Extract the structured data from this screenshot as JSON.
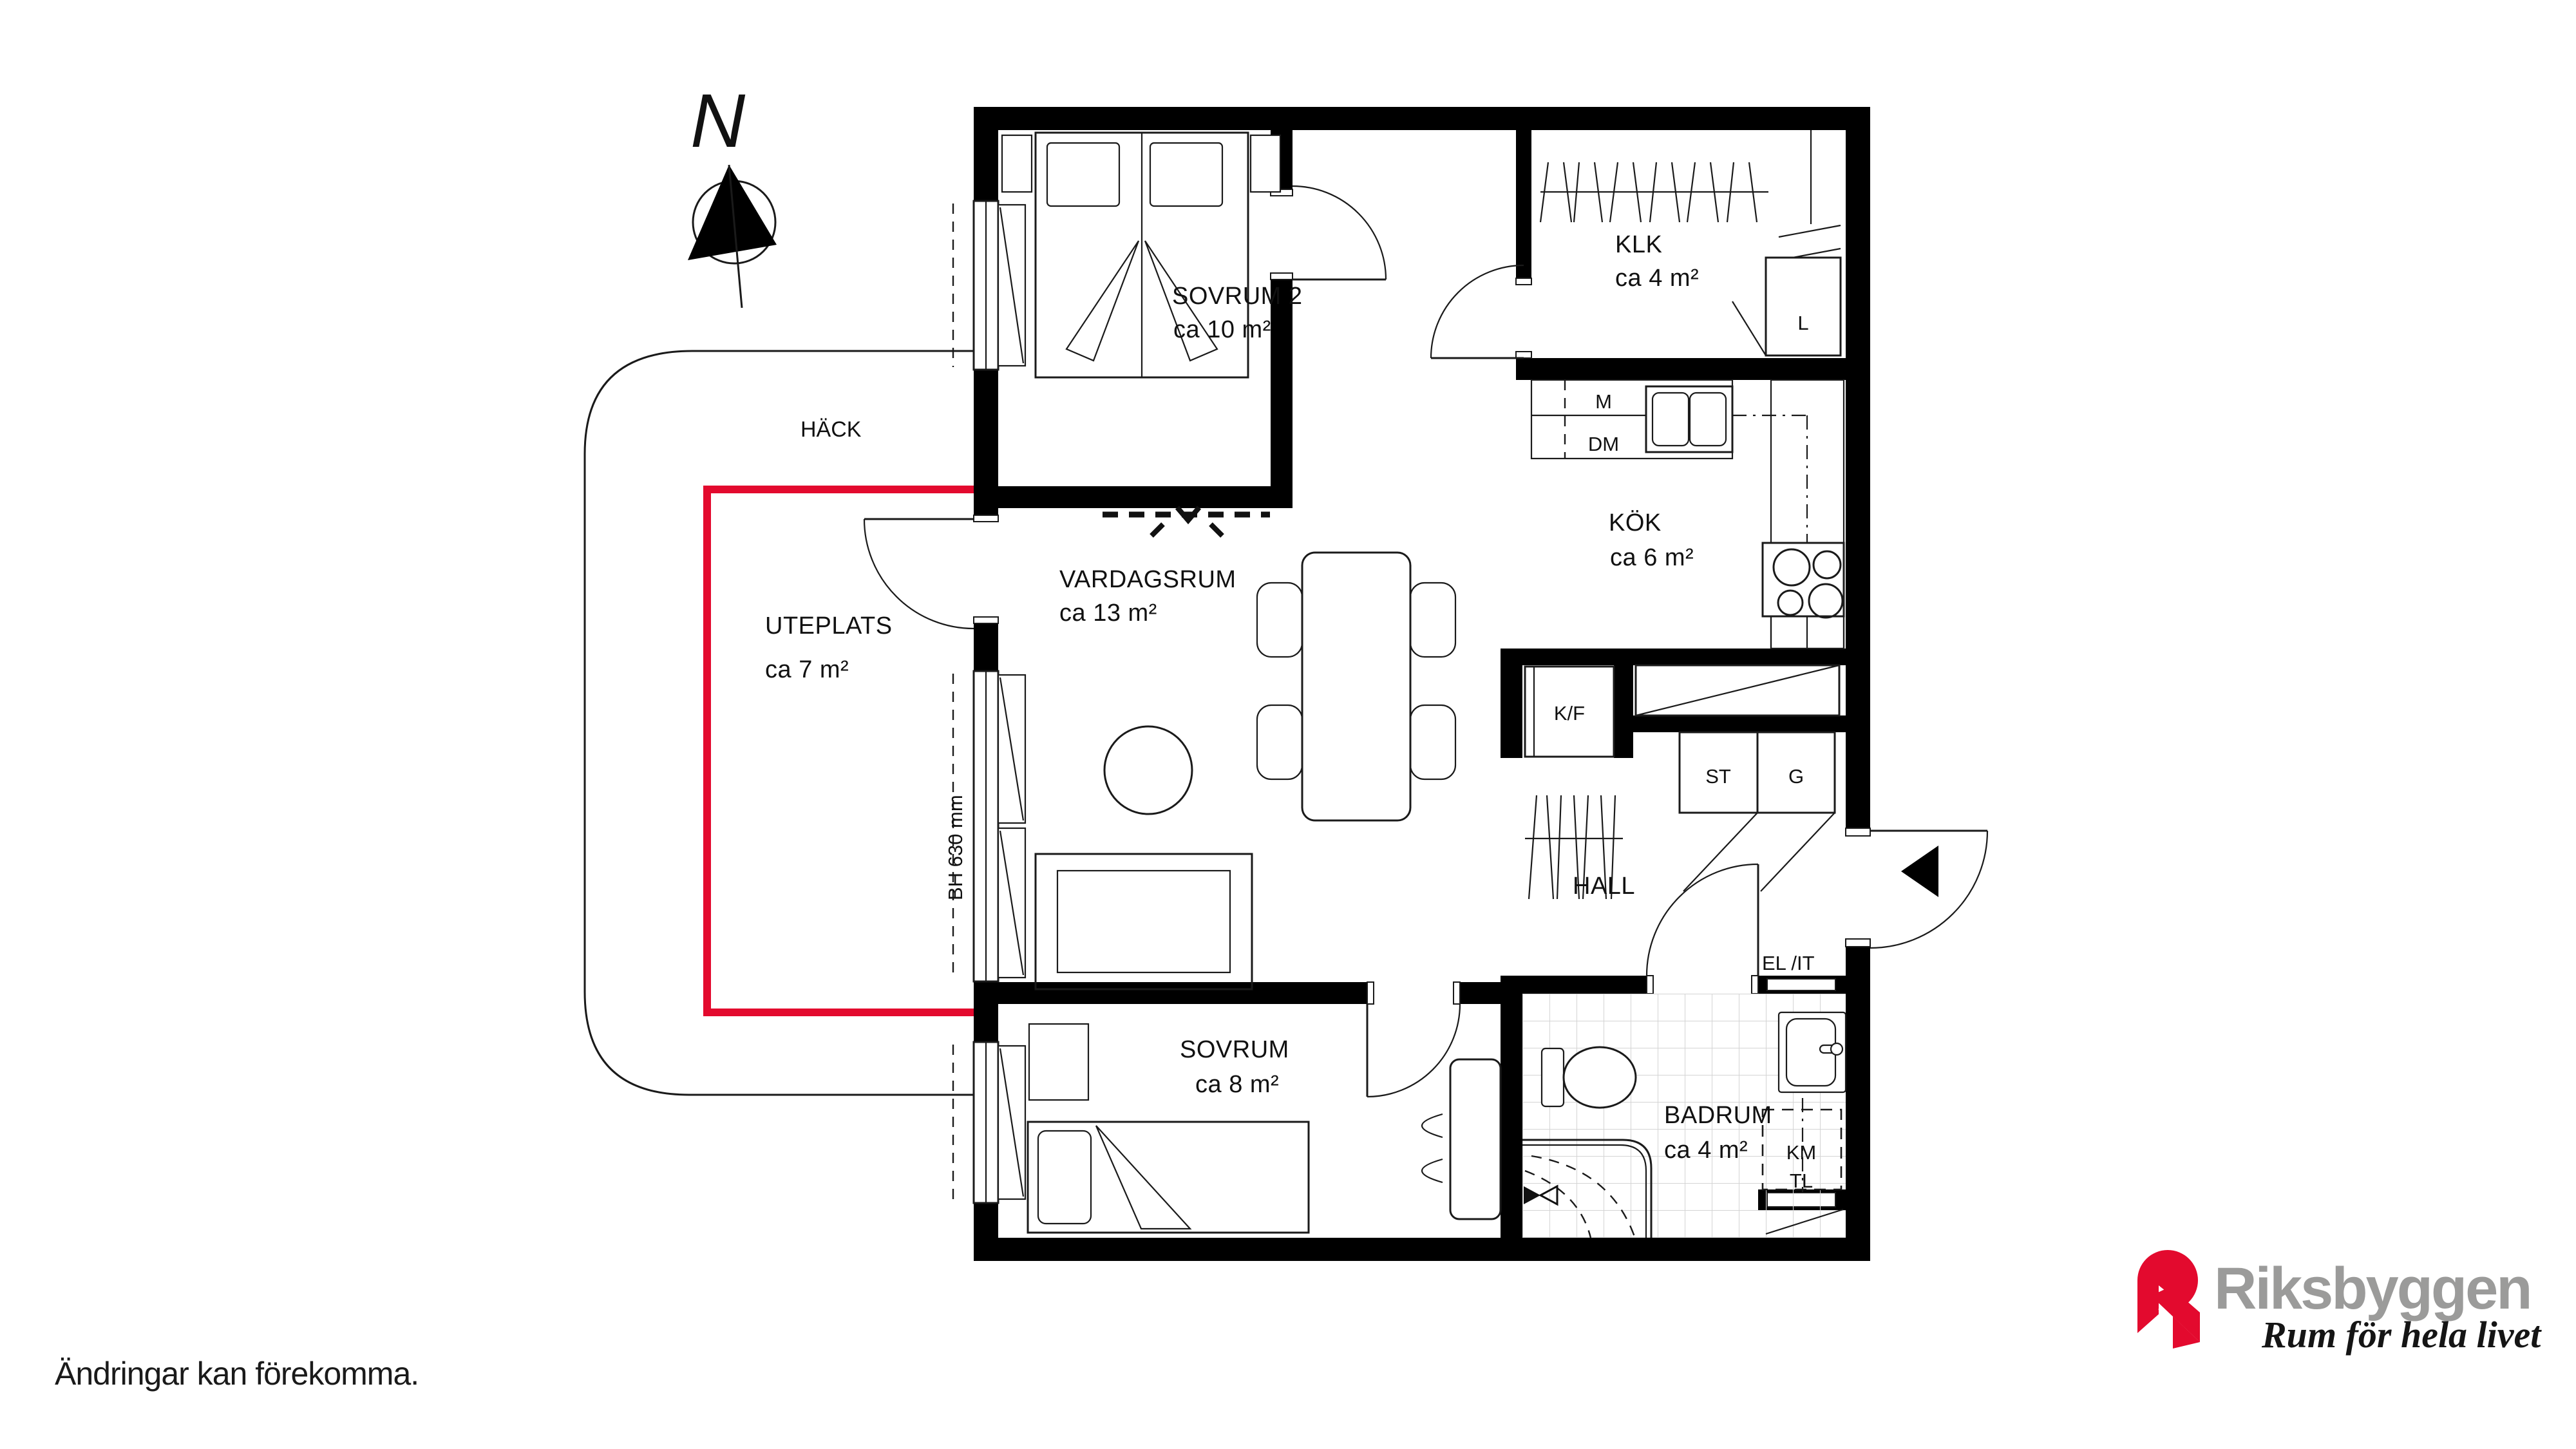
{
  "meta": {
    "disclaimer": "Ändringar kan förekomma."
  },
  "compass": {
    "label": "N"
  },
  "site": {
    "hedge_label": "HÄCK",
    "patio": {
      "name": "UTEPLATS",
      "area": "ca 7 m²"
    },
    "window_height_note": "BH 630 mm"
  },
  "rooms": {
    "sovrum2": {
      "name": "SOVRUM 2",
      "area": "ca 10 m²"
    },
    "klk": {
      "name": "KLK",
      "area": "ca 4 m²"
    },
    "kok": {
      "name": "KÖK",
      "area": "ca 6 m²"
    },
    "vardagsrum": {
      "name": "VARDAGSRUM",
      "area": "ca 13 m²"
    },
    "hall": {
      "name": "HALL"
    },
    "sovrum": {
      "name": "SOVRUM",
      "area": "ca 8 m²"
    },
    "badrum": {
      "name": "BADRUM",
      "area": "ca 4 m²"
    }
  },
  "fixtures": {
    "micro": "M",
    "dishwasher": "DM",
    "fridge_freezer": "K/F",
    "cleaning_closet": "ST",
    "wardrobe": "G",
    "linen_closet": "L",
    "washer": "KM",
    "dryer": "TL",
    "electrical": "EL /IT"
  },
  "logo": {
    "brand": "Riksbyggen",
    "tagline": "Rum för hela livet"
  },
  "colors": {
    "accent_red": "#e30a2e",
    "brand_gray": "#9b9b9a",
    "wall_black": "#000000",
    "tile_gray": "#d4d4d4"
  }
}
